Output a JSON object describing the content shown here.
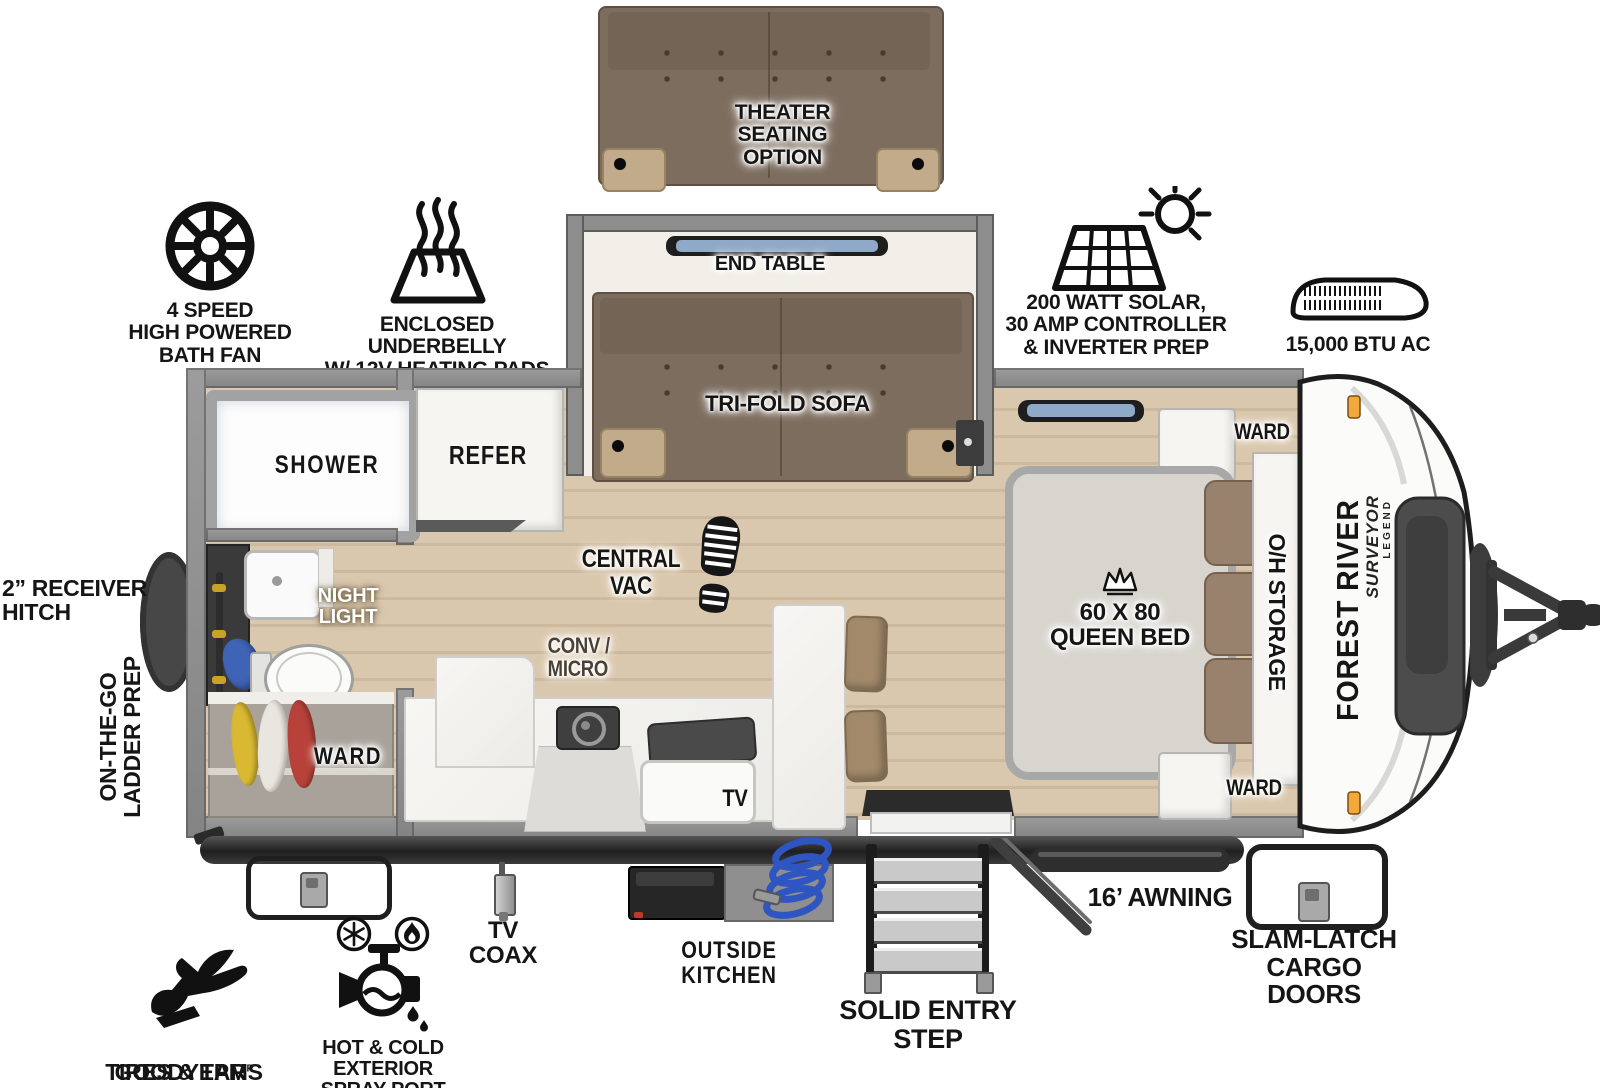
{
  "options": {
    "theater_seating": "THEATER SEATING\nOPTION"
  },
  "slideout": {
    "end_table": "END TABLE",
    "tri_fold_sofa": "TRI-FOLD SOFA"
  },
  "features": {
    "bath_fan": "4 SPEED\nHIGH POWERED\nBATH FAN",
    "underbelly": "ENCLOSED UNDERBELLY\nW/ 12V HEATING PADS",
    "solar": "200 WATT SOLAR,\n30 AMP CONTROLLER\n& INVERTER PREP",
    "ac": "15,000 BTU AC"
  },
  "rooms": {
    "shower": "SHOWER",
    "refer": "REFER",
    "night_light": "NIGHT\nLIGHT",
    "bath_ward": "WARD",
    "central_vac": "CENTRAL\nVAC",
    "conv_micro": "CONV /\nMICRO",
    "tv": "TV",
    "queen_bed": "60 X 80\nQUEEN BED",
    "ward_front_top": "WARD",
    "oh_storage": "O/H STORAGE",
    "ward_front_bottom": "WARD"
  },
  "exterior": {
    "receiver_hitch": "2” RECEIVER\nHITCH",
    "ladder_prep": "ON-THE-GO\nLADDER PREP",
    "goodyear_brand": "GOODYEAR",
    "goodyear_reg": "R",
    "goodyear_sub": "TIRES & TPMS",
    "spray_port": "HOT & COLD EXTERIOR\nSPRAY PORT",
    "tv_coax": "TV\nCOAX",
    "outside_kitchen": "OUTSIDE KITCHEN",
    "entry_step": "SOLID ENTRY\nSTEP",
    "awning": "16’ AWNING",
    "cargo_doors": "SLAM-LATCH\nCARGO DOORS"
  },
  "branding": {
    "make": "FOREST RIVER",
    "series": "SURVEYOR",
    "trim": "LEGEND"
  },
  "colors": {
    "wood_floor": "#dac8ae",
    "wall_gray": "#8d8d8d",
    "sofa_brown": "#7d6d5f",
    "armrest_tan": "#c2ab8b",
    "pillow_brown": "#98816d",
    "hose_blue": "#2f55c0",
    "towel_blue": "#3f63b5",
    "marker_amber": "#f2a93b",
    "clothes_yellow": "#d9b832",
    "clothes_red": "#b8423a"
  }
}
